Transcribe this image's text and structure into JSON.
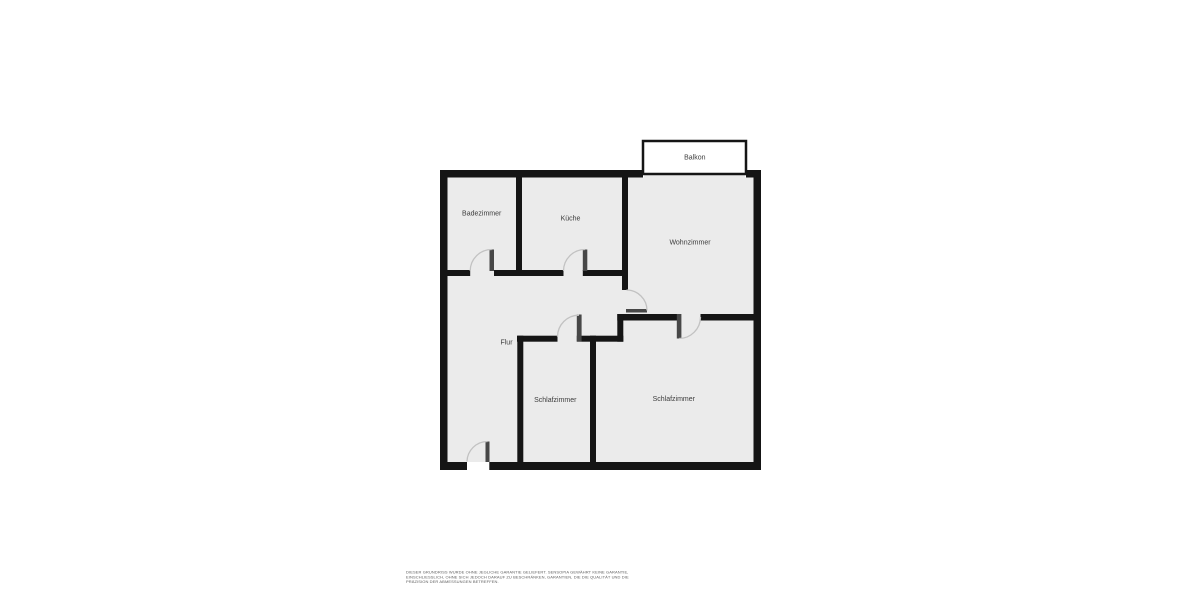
{
  "floor_plan": {
    "rooms": {
      "balkon": {
        "label": "Balkon"
      },
      "badezimmer": {
        "label": "Badezimmer"
      },
      "kueche": {
        "label": "Küche"
      },
      "wohnzimmer": {
        "label": "Wohnzimmer"
      },
      "flur": {
        "label": "Flur"
      },
      "schlafzimmer_mitte": {
        "label": "Schlafzimmer"
      },
      "schlafzimmer_rechts": {
        "label": "Schlafzimmer"
      }
    },
    "colors": {
      "background": "#ffffff",
      "wall": "#151515",
      "room_fill": "#ebebeb",
      "balkon_fill": "#ffffff",
      "door_leaf": "#474747",
      "door_arc": "#c2c2c2",
      "label_text": "#3c3c3c",
      "disclaimer_text": "#606060"
    },
    "disclaimer": {
      "line1": "DIESER GRUNDRISS WURDE OHNE JEGLICHE GARANTIE GELIEFERT. SENSOPIA GEWÄHRT KEINE GARANTIE,",
      "line2": "EINSCHLIESSLICH, OHNE SICH JEDOCH DARAUF ZU BESCHRÄNKEN, GARANTIEN, DIE DIE QUALITÄT UND DIE",
      "line3": "PRÄZISION DER ABMESSUNGEN BETREFFEN."
    }
  }
}
